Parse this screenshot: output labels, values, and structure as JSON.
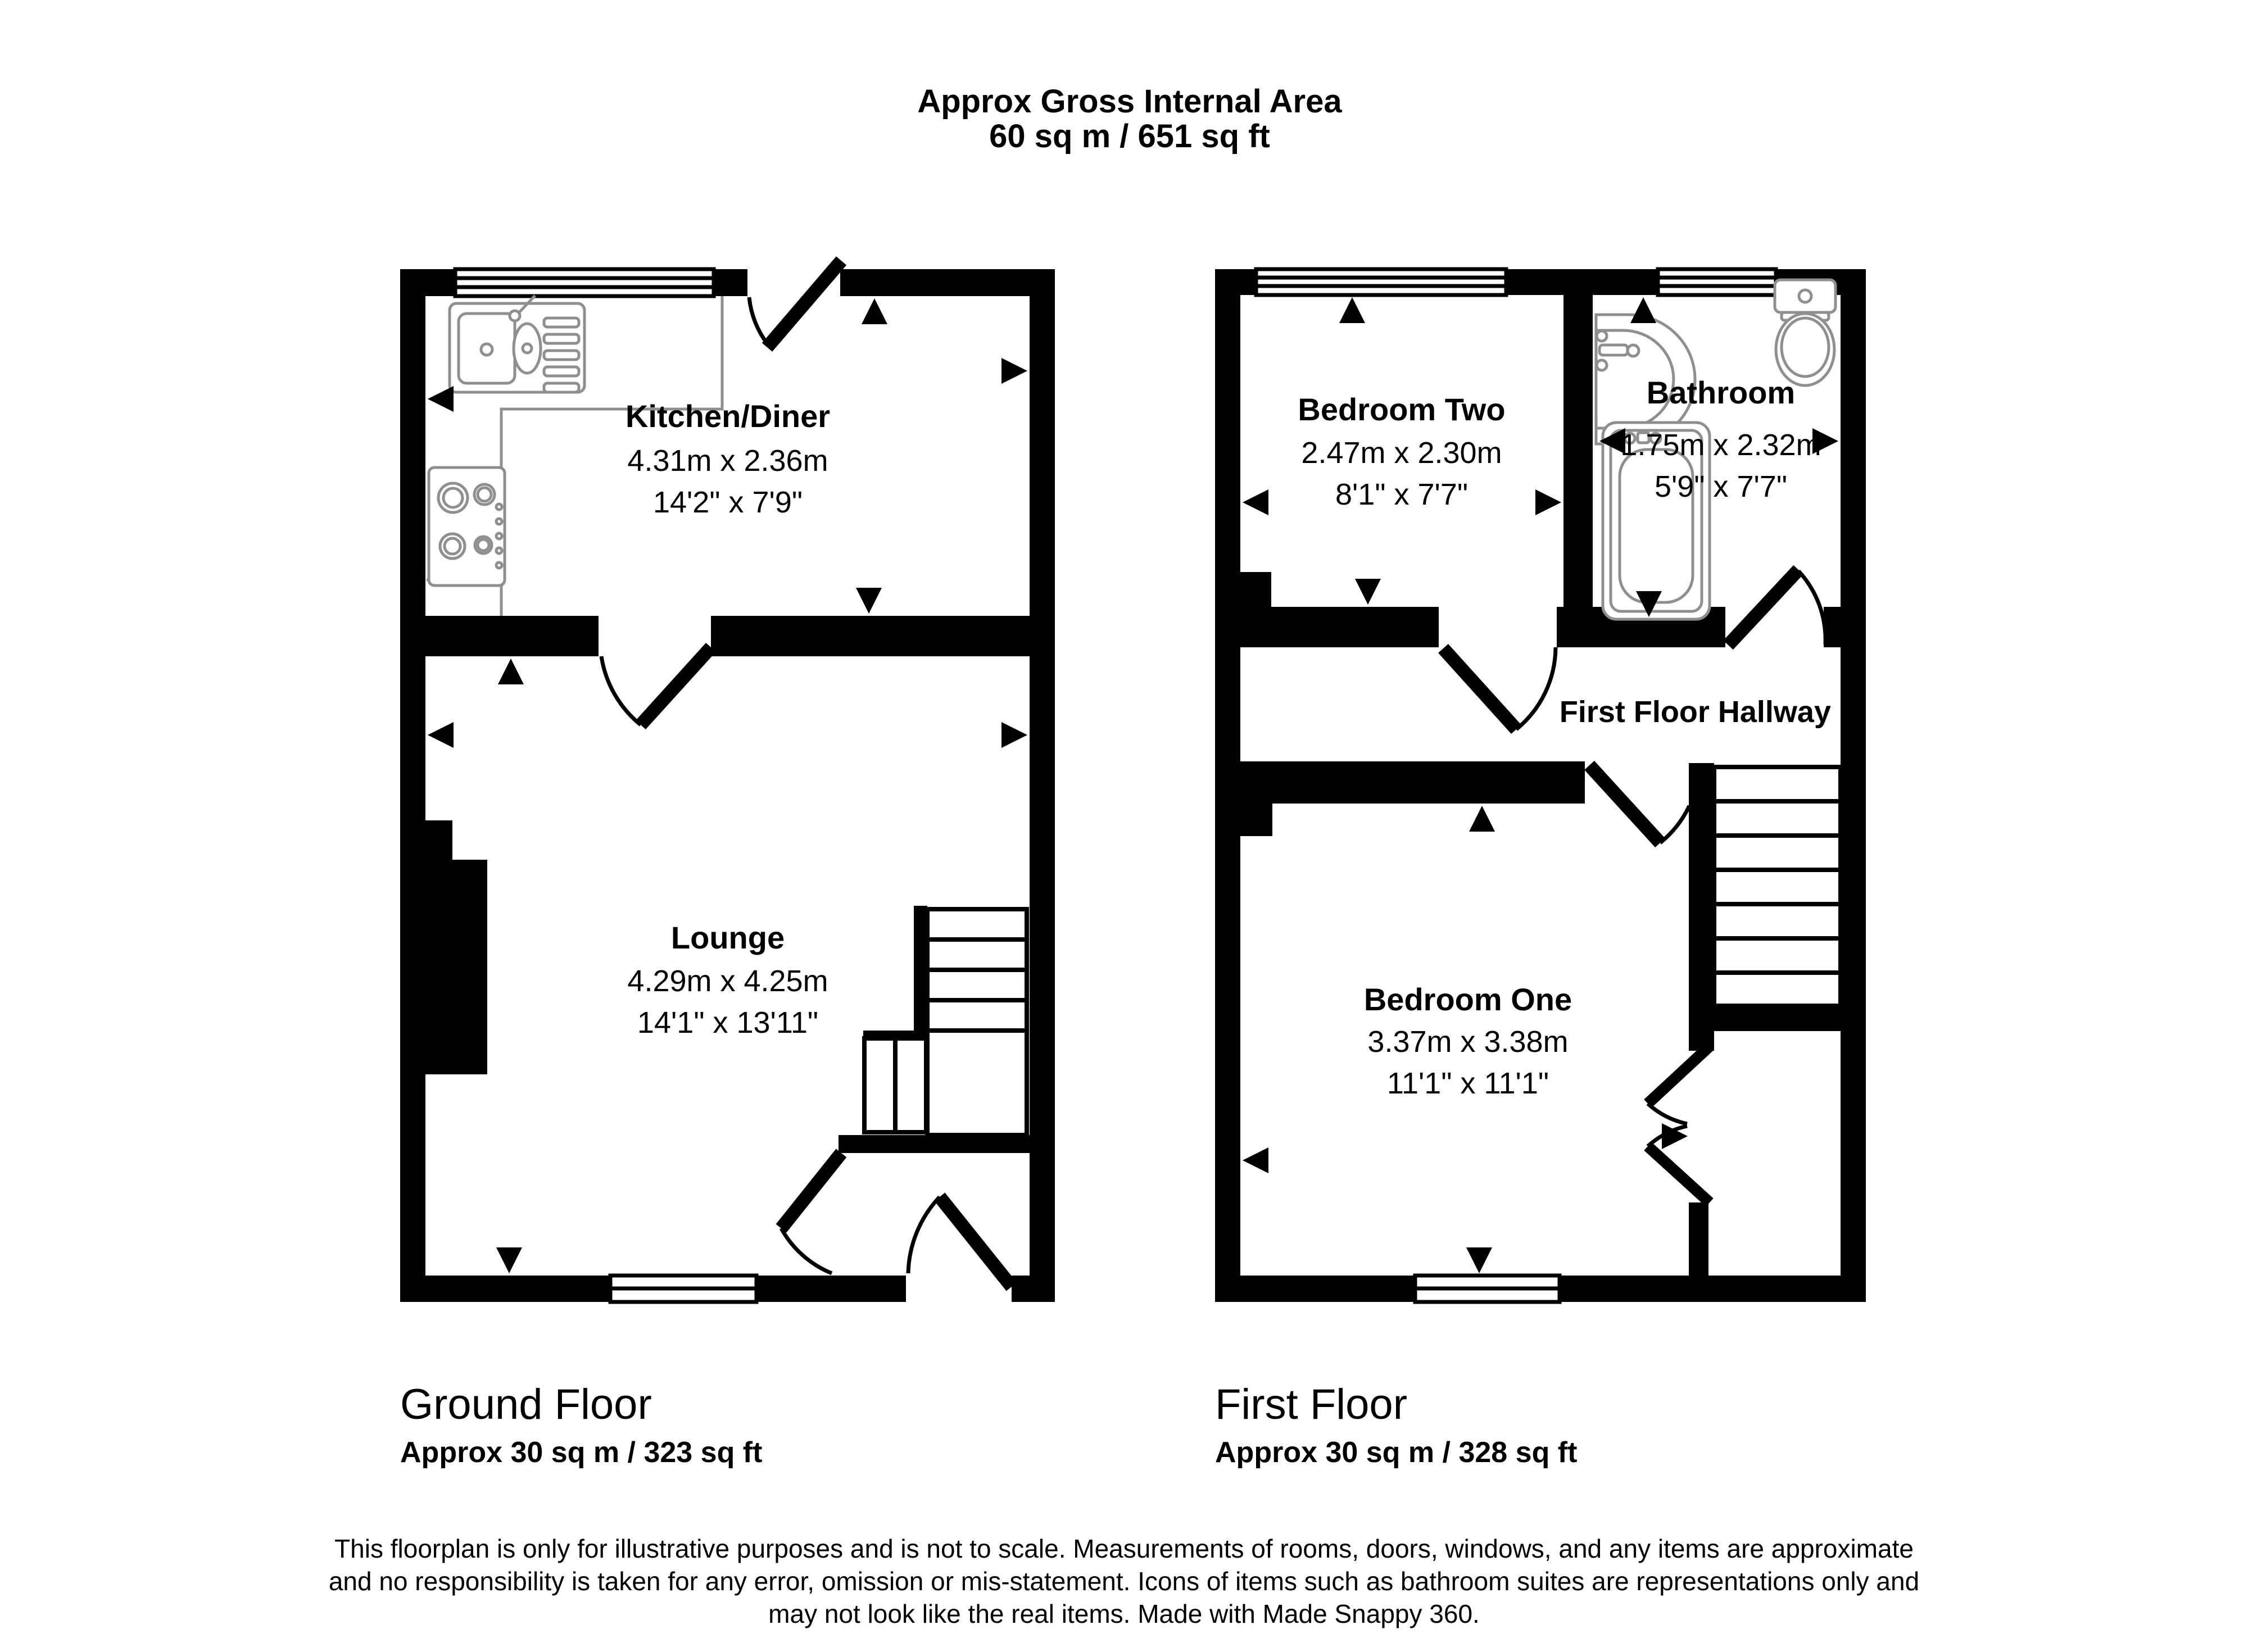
{
  "header": {
    "title": "Approx Gross Internal Area",
    "total_area": "60 sq m / 651 sq ft"
  },
  "ground_floor": {
    "label": "Ground Floor",
    "area": "Approx 30 sq m / 323 sq ft",
    "rooms": {
      "kitchen_diner": {
        "name": "Kitchen/Diner",
        "metric": "4.31m x 2.36m",
        "imperial": "14'2\" x 7'9\""
      },
      "lounge": {
        "name": "Lounge",
        "metric": "4.29m x 4.25m",
        "imperial": "14'1\" x 13'11\""
      }
    }
  },
  "first_floor": {
    "label": "First Floor",
    "area": "Approx 30 sq m / 328 sq ft",
    "rooms": {
      "bedroom_two": {
        "name": "Bedroom Two",
        "metric": "2.47m x 2.30m",
        "imperial": "8'1\" x 7'7\""
      },
      "bathroom": {
        "name": "Bathroom",
        "metric": "1.75m x 2.32m",
        "imperial": "5'9\" x 7'7\""
      },
      "hallway": {
        "name": "First Floor Hallway"
      },
      "bedroom_one": {
        "name": "Bedroom One",
        "metric": "3.37m x 3.38m",
        "imperial": "11'1\" x 11'1\""
      }
    }
  },
  "disclaimer": {
    "line1": "This floorplan is only for illustrative purposes and is not to scale. Measurements of rooms, doors, windows, and any items are approximate",
    "line2": "and no responsibility is taken for any error, omission or mis-statement. Icons of items such as bathroom suites are representations only and",
    "line3": "may not look like the real items. Made with Made Snappy 360."
  },
  "colors": {
    "wall": "#000000",
    "fixture_outline": "#8f8f8f",
    "background": "#ffffff"
  }
}
